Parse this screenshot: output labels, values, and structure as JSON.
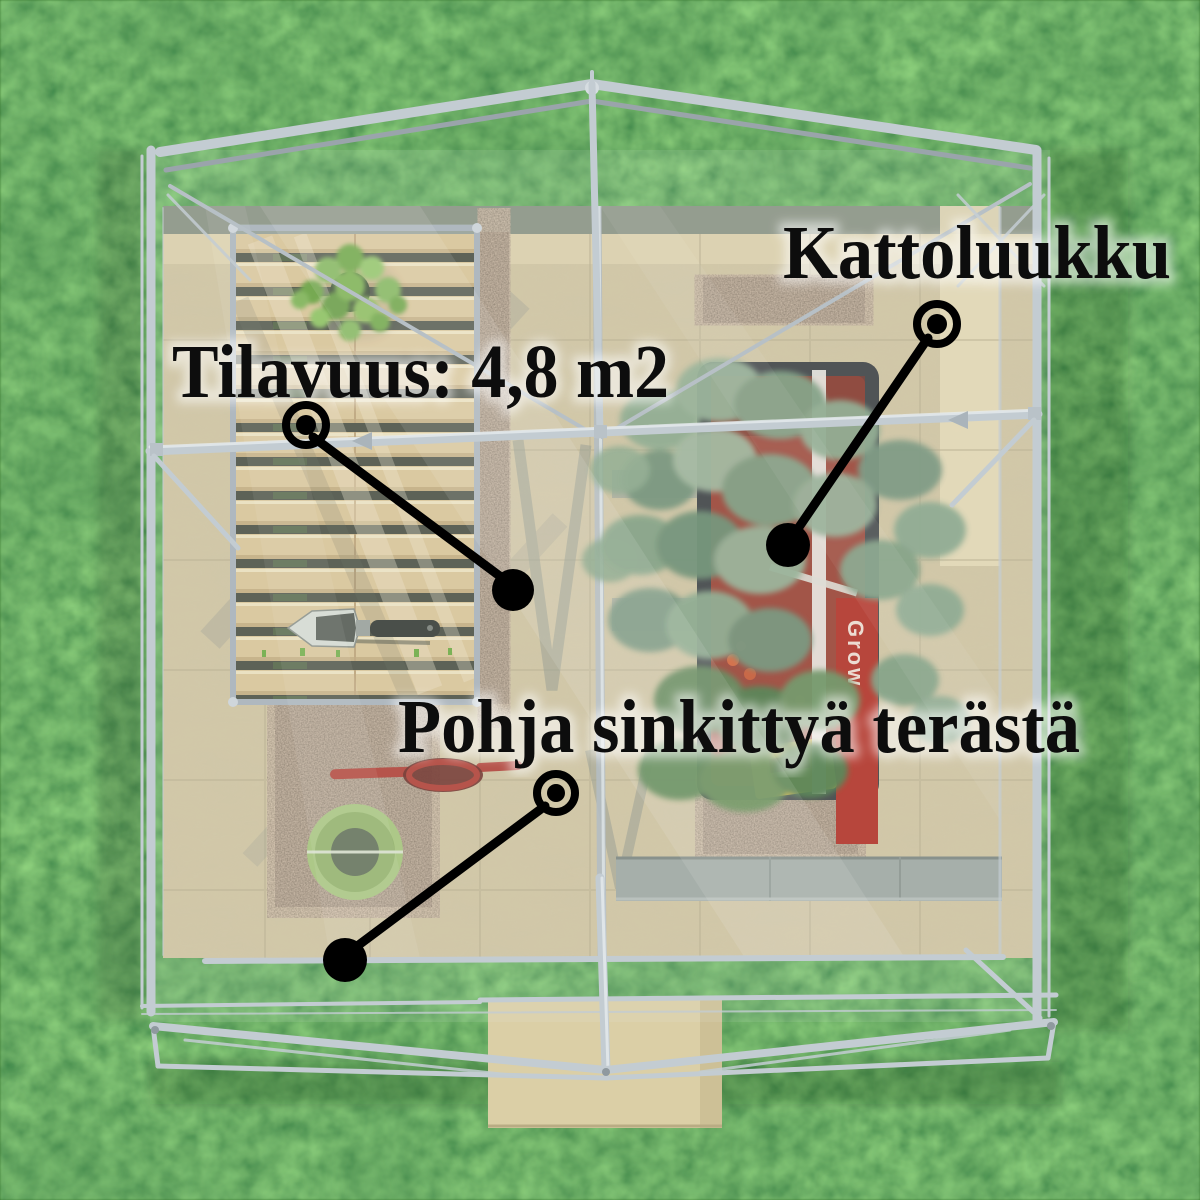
{
  "callouts": {
    "volume": {
      "label": "Tilavuus: 4,8 m2"
    },
    "roof_hatch": {
      "label": "Kattoluukku"
    },
    "base_material": {
      "label": "Pohja sinkittyä terästä"
    }
  },
  "planter": {
    "seed_box_label": "Grow"
  },
  "palette": {
    "label_text": "#0d0d0d",
    "marker_black": "#000000",
    "grass_base": "#2f6d24",
    "frame_aluminum": "#c3ccd2",
    "floor_tile": "#cfc3a0",
    "bench_wood": "#d9c498",
    "gravel_brown": "#6d5c4a",
    "planter_red": "#9a4335",
    "foliage_grey_green": "#87a489",
    "pot_green": "#a6c37c",
    "shears_red": "#b04238"
  }
}
